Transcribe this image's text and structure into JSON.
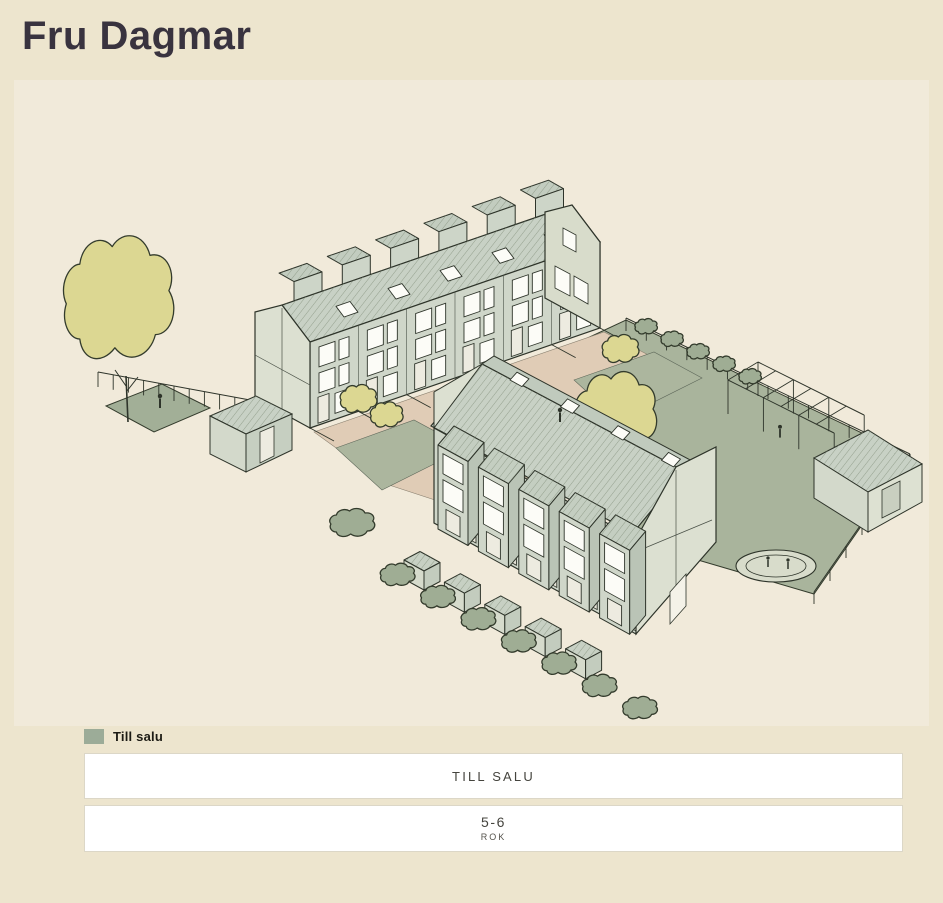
{
  "header": {
    "title": "Fru Dagmar"
  },
  "legend": {
    "items": [
      {
        "label": "Till salu",
        "color": "#9CAC98"
      }
    ]
  },
  "filters": {
    "status": {
      "label": "TILL SALU"
    },
    "rooms": {
      "value": "5-6",
      "unit": "ROK"
    }
  },
  "colors": {
    "page_bg": "#EDE5CE",
    "panel_bg": "#F1EADA",
    "title_text": "#39333F",
    "button_bg": "#FFFFFF",
    "button_text": "#45443E",
    "for_sale_accent": "#9CAC98",
    "roof": "#C8D1C5",
    "wall": "#CFD6C9",
    "lawn": "#A9B49C",
    "path": "#E0CCB6",
    "tree": "#DCD792"
  }
}
